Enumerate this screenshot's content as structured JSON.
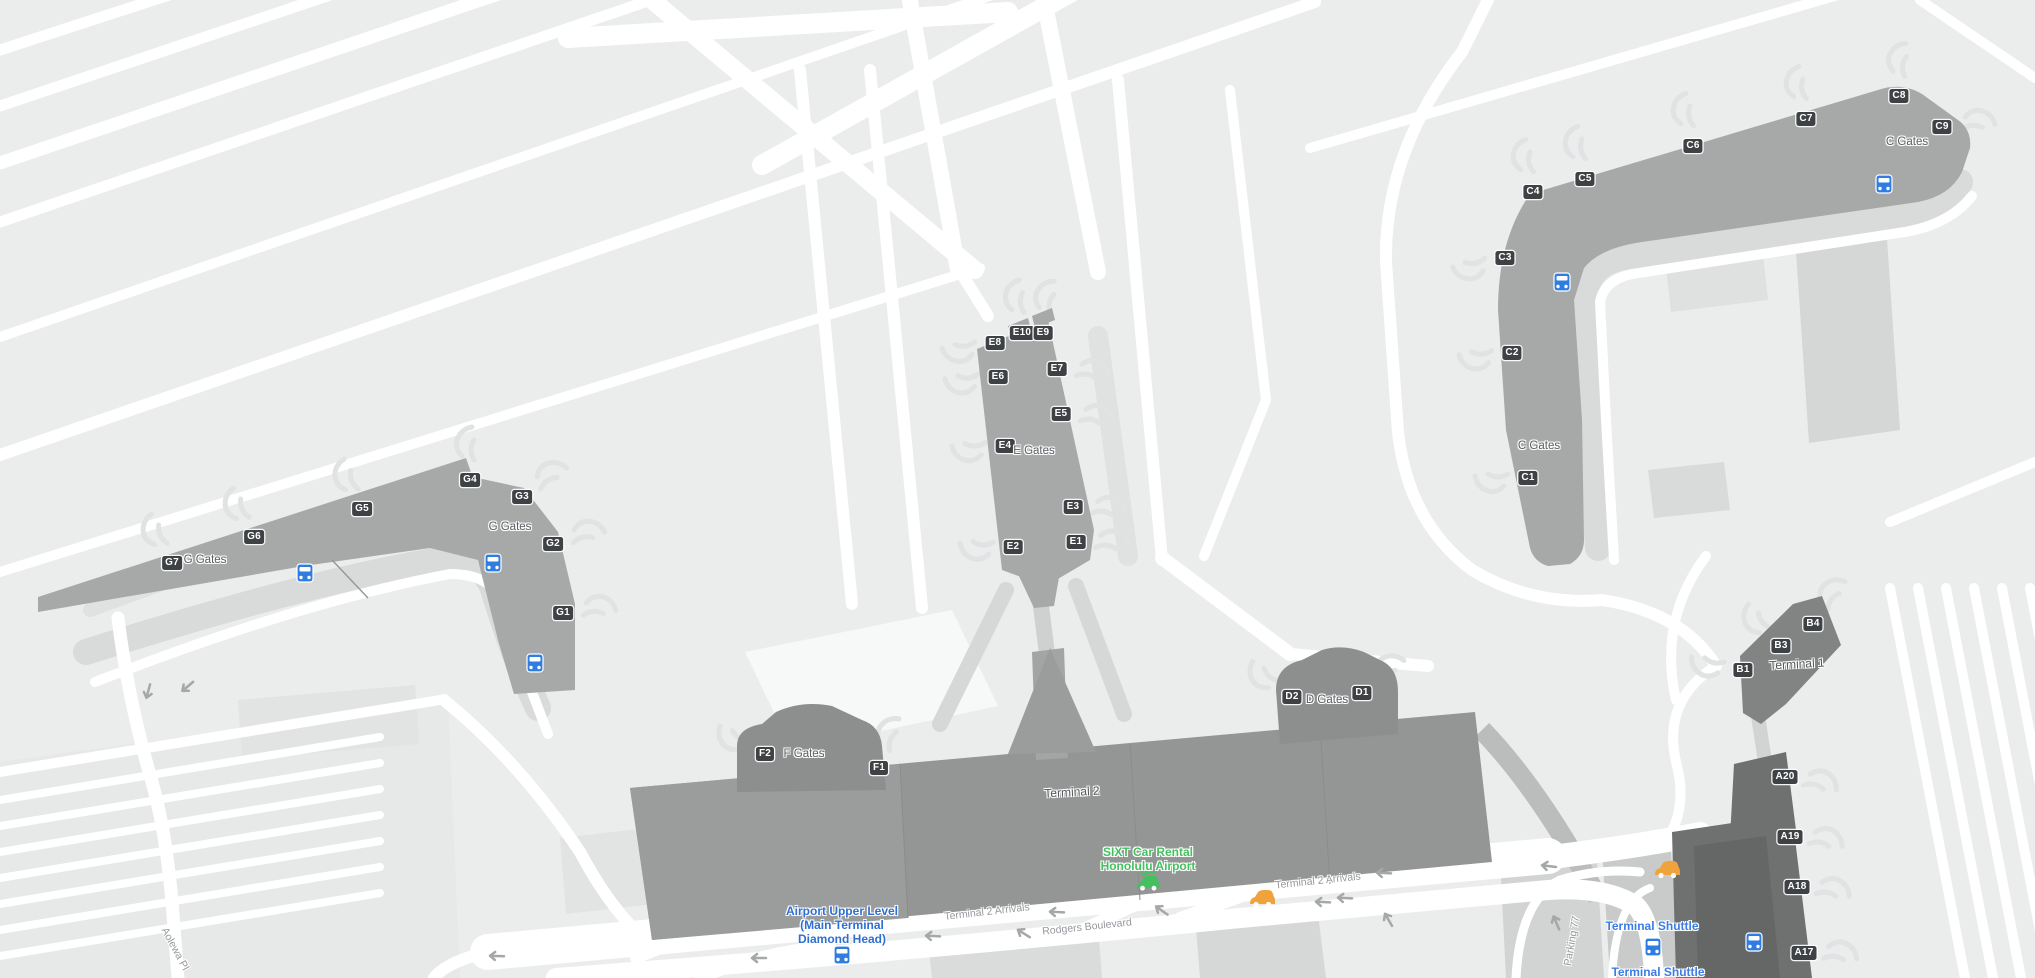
{
  "map": {
    "name": "Honolulu International Airport terminal map",
    "colors": {
      "background": "#ebecec",
      "road": "#ffffff",
      "apron": "#d9dada",
      "pier": "#a7a8a8",
      "terminal": "#949595",
      "gate_wing": "#8d8e8e",
      "a_pier": "#6f7070",
      "terminal1": "#828383",
      "badge_bg": "#3e4245",
      "badge_text": "#ffffff",
      "poi_blue": "#2e6fd0",
      "shuttle_blue": "#3b7de2",
      "poi_green": "#44c05f",
      "bus_blue": "#2f7de1",
      "car_yellow": "#f0a33c"
    },
    "gates": [
      {
        "label": "G7",
        "x": 172,
        "y": 563,
        "dir": -115
      },
      {
        "label": "G6",
        "x": 254,
        "y": 537,
        "dir": -115
      },
      {
        "label": "G5",
        "x": 362,
        "y": 509,
        "dir": -112
      },
      {
        "label": "G4",
        "x": 470,
        "y": 480,
        "dir": -90
      },
      {
        "label": "G3",
        "x": 522,
        "y": 497,
        "dir": -35
      },
      {
        "label": "G2",
        "x": 553,
        "y": 544,
        "dir": -15
      },
      {
        "label": "G1",
        "x": 563,
        "y": 613,
        "dir": -5
      },
      {
        "label": "E8",
        "x": 995,
        "y": 343,
        "dir": 172
      },
      {
        "label": "E10",
        "x": 1022,
        "y": 333,
        "dir": -95
      },
      {
        "label": "E9",
        "x": 1043,
        "y": 333,
        "dir": -80
      },
      {
        "label": "E7",
        "x": 1057,
        "y": 369,
        "dir": 8
      },
      {
        "label": "E6",
        "x": 998,
        "y": 377,
        "dir": 176
      },
      {
        "label": "E5",
        "x": 1061,
        "y": 414,
        "dir": 8
      },
      {
        "label": "E4",
        "x": 1005,
        "y": 446,
        "dir": 178
      },
      {
        "label": "E3",
        "x": 1073,
        "y": 507,
        "dir": 6
      },
      {
        "label": "E2",
        "x": 1013,
        "y": 547,
        "dir": 182
      },
      {
        "label": "E1",
        "x": 1076,
        "y": 542,
        "dir": 4
      },
      {
        "label": "C4",
        "x": 1533,
        "y": 192,
        "dir": -100
      },
      {
        "label": "C5",
        "x": 1585,
        "y": 179,
        "dir": -100
      },
      {
        "label": "C6",
        "x": 1693,
        "y": 146,
        "dir": -100
      },
      {
        "label": "C7",
        "x": 1806,
        "y": 119,
        "dir": -100
      },
      {
        "label": "C8",
        "x": 1899,
        "y": 96,
        "dir": -85
      },
      {
        "label": "C9",
        "x": 1942,
        "y": 127,
        "dir": -5
      },
      {
        "label": "C3",
        "x": 1505,
        "y": 258,
        "dir": 168
      },
      {
        "label": "C2",
        "x": 1512,
        "y": 353,
        "dir": 176
      },
      {
        "label": "C1",
        "x": 1528,
        "y": 478,
        "dir": 180
      },
      {
        "label": "B4",
        "x": 1813,
        "y": 624,
        "dir": -55
      },
      {
        "label": "B3",
        "x": 1781,
        "y": 646,
        "dir": -130
      },
      {
        "label": "B1",
        "x": 1743,
        "y": 670,
        "dir": -168
      },
      {
        "label": "A20",
        "x": 1785,
        "y": 777,
        "dir": 12
      },
      {
        "label": "A19",
        "x": 1790,
        "y": 837,
        "dir": 8
      },
      {
        "label": "A18",
        "x": 1797,
        "y": 887,
        "dir": 8
      },
      {
        "label": "A17",
        "x": 1804,
        "y": 953,
        "dir": 4
      },
      {
        "label": "F2",
        "x": 765,
        "y": 754,
        "dir": -150
      },
      {
        "label": "F1",
        "x": 879,
        "y": 768,
        "dir": -70
      },
      {
        "label": "D2",
        "x": 1292,
        "y": 697,
        "dir": -140
      },
      {
        "label": "D1",
        "x": 1362,
        "y": 693,
        "dir": -40
      }
    ],
    "area_labels": [
      {
        "id": "g-gates-west",
        "text": "G Gates",
        "x": 205,
        "y": 560
      },
      {
        "id": "g-gates-east",
        "text": "G Gates",
        "x": 510,
        "y": 527
      },
      {
        "id": "e-gates",
        "text": "E Gates",
        "x": 1034,
        "y": 451
      },
      {
        "id": "c-gates-head",
        "text": "C Gates",
        "x": 1907,
        "y": 142
      },
      {
        "id": "c-gates-leg",
        "text": "C Gates",
        "x": 1539,
        "y": 446
      },
      {
        "id": "f-gates",
        "text": "F Gates",
        "x": 804,
        "y": 754
      },
      {
        "id": "d-gates",
        "text": "D Gates",
        "x": 1327,
        "y": 700
      }
    ],
    "terminal_labels": {
      "t2": {
        "text": "Terminal 2",
        "x": 1072,
        "y": 792
      },
      "t1": {
        "text": "Terminal 1",
        "x": 1797,
        "y": 664
      }
    },
    "road_labels": [
      {
        "id": "t2-arrivals-west",
        "text": "Terminal 2 Arrivals",
        "x": 987,
        "y": 912,
        "angle": -6.5
      },
      {
        "id": "t2-arrivals-east",
        "text": "Terminal 2 Arrivals",
        "x": 1318,
        "y": 881,
        "angle": -6
      },
      {
        "id": "rodgers-blvd",
        "text": "Rodgers Boulevard",
        "x": 1087,
        "y": 927,
        "angle": -6
      },
      {
        "id": "parking-77",
        "text": "Parking 77",
        "x": 1572,
        "y": 941,
        "angle": -80
      },
      {
        "id": "aolewa-pl",
        "text": "Aolewa Pl",
        "x": 175,
        "y": 949,
        "angle": 62
      }
    ],
    "poi_labels": [
      {
        "id": "sixt-car-rental",
        "lines": [
          "SIXT Car Rental",
          "Honolulu Airport"
        ],
        "x": 1148,
        "y": 859,
        "color": "#44c05f"
      },
      {
        "id": "airport-upper-level",
        "lines": [
          "Airport Upper Level",
          "(Main Terminal",
          "Diamond Head)"
        ],
        "x": 842,
        "y": 925,
        "color": "#2e6fd0"
      },
      {
        "id": "terminal-shuttle-1",
        "lines": [
          "Terminal Shuttle"
        ],
        "x": 1652,
        "y": 926,
        "color": "#3b7de2"
      },
      {
        "id": "terminal-shuttle-2",
        "lines": [
          "Terminal Shuttle"
        ],
        "x": 1658,
        "y": 972,
        "color": "#3b7de2"
      }
    ],
    "bus_stops": [
      {
        "x": 305,
        "y": 573
      },
      {
        "x": 493,
        "y": 563
      },
      {
        "x": 535,
        "y": 663
      },
      {
        "x": 842,
        "y": 955
      },
      {
        "x": 1562,
        "y": 282
      },
      {
        "x": 1884,
        "y": 184
      },
      {
        "x": 1653,
        "y": 947
      },
      {
        "x": 1754,
        "y": 942
      }
    ],
    "car_icons": [
      {
        "x": 1262,
        "y": 900
      },
      {
        "x": 1667,
        "y": 871
      }
    ],
    "rental_car_icon": {
      "x": 1148,
      "y": 884
    },
    "arrows": [
      {
        "x": 758,
        "y": 958,
        "a": 180
      },
      {
        "x": 932,
        "y": 936,
        "a": 183
      },
      {
        "x": 1023,
        "y": 933,
        "a": 212
      },
      {
        "x": 1056,
        "y": 912,
        "a": 183
      },
      {
        "x": 1161,
        "y": 910,
        "a": 215
      },
      {
        "x": 1322,
        "y": 902,
        "a": 183
      },
      {
        "x": 1344,
        "y": 898,
        "a": 183
      },
      {
        "x": 1383,
        "y": 873,
        "a": 183
      },
      {
        "x": 1388,
        "y": 919,
        "a": 240
      },
      {
        "x": 496,
        "y": 956,
        "a": 182
      },
      {
        "x": 187,
        "y": 687,
        "a": 140
      },
      {
        "x": 1548,
        "y": 866,
        "a": 187
      },
      {
        "x": 1556,
        "y": 922,
        "a": 247
      },
      {
        "x": 148,
        "y": 692,
        "a": 105
      }
    ]
  }
}
